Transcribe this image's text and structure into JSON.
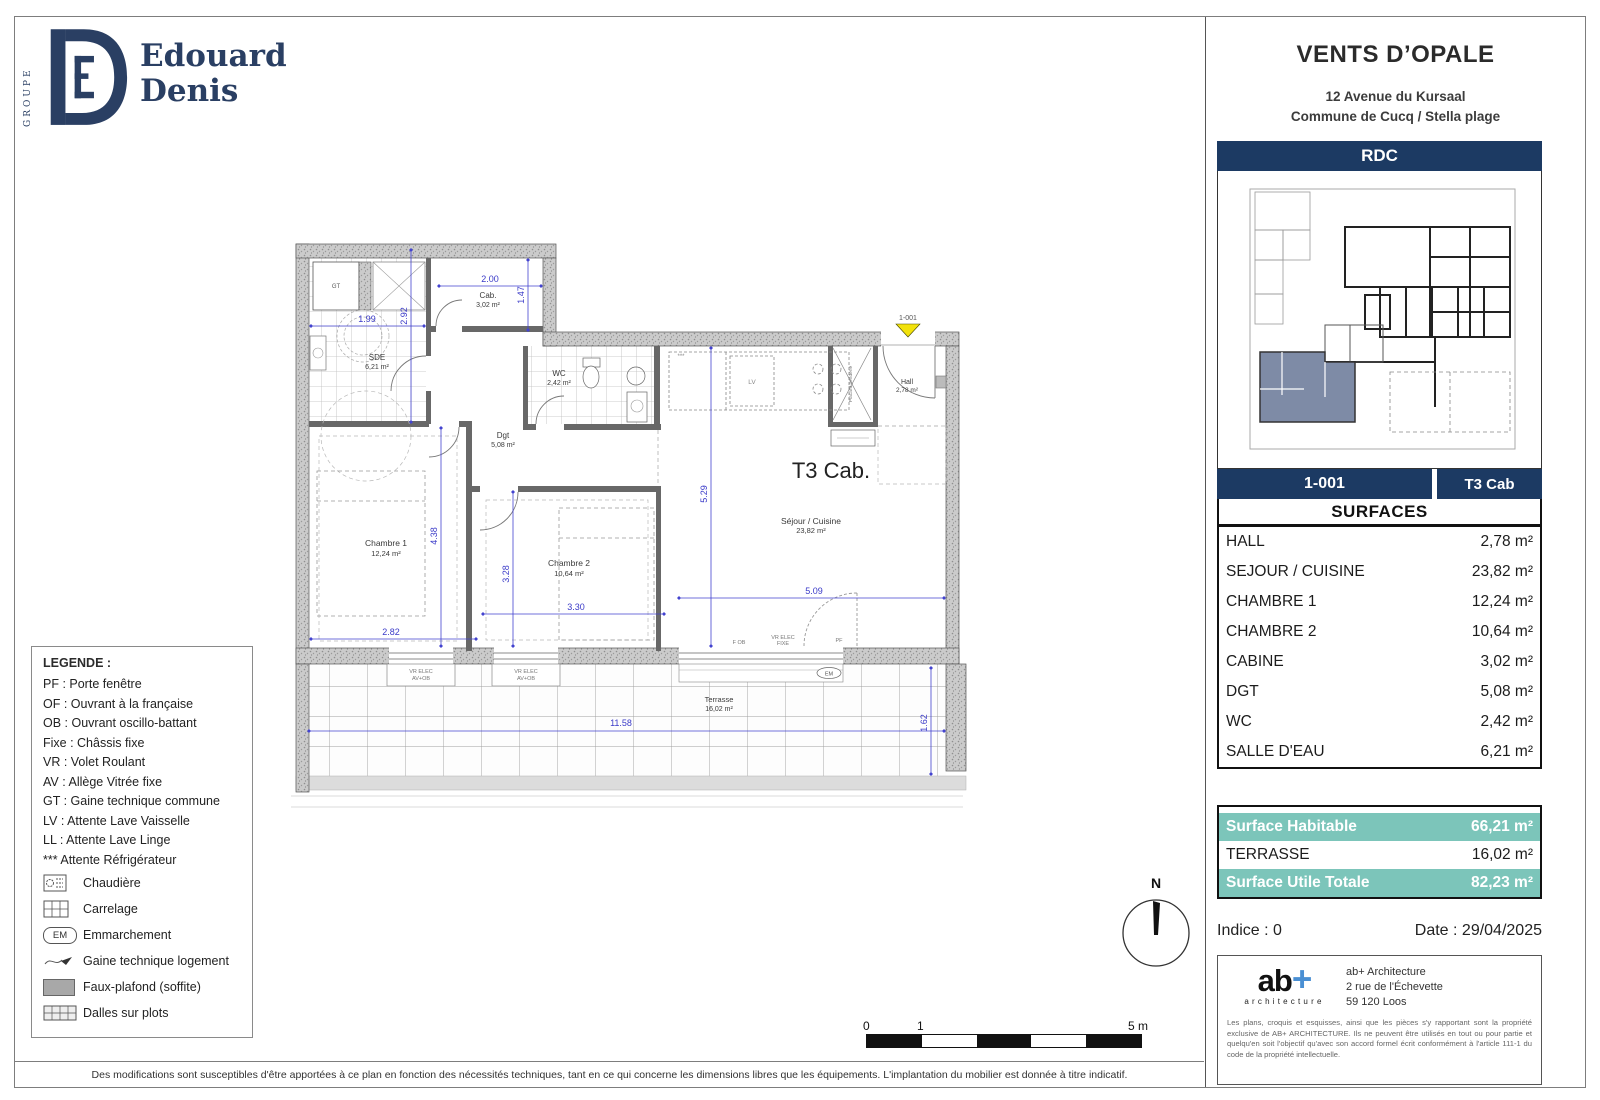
{
  "branding": {
    "groupe": "GROUPE",
    "line1": "Edouard",
    "line2": "Denis"
  },
  "project": {
    "title": "VENTS D’OPALE",
    "address1": "12 Avenue du Kursaal",
    "address2": "Commune de Cucq / Stella plage",
    "level": "RDC",
    "unit": "1-001",
    "unit_type": "T3 Cab"
  },
  "surfaces": {
    "header": "SURFACES",
    "rows": [
      {
        "label": "HALL",
        "value": "2,78 m²"
      },
      {
        "label": "SEJOUR / CUISINE",
        "value": "23,82 m²"
      },
      {
        "label": "CHAMBRE 1",
        "value": "12,24 m²"
      },
      {
        "label": "CHAMBRE 2",
        "value": "10,64 m²"
      },
      {
        "label": "CABINE",
        "value": "3,02 m²"
      },
      {
        "label": "DGT",
        "value": "5,08 m²"
      },
      {
        "label": "WC",
        "value": "2,42 m²"
      },
      {
        "label": "SALLE D'EAU",
        "value": "6,21 m²"
      }
    ]
  },
  "totals": [
    {
      "label": "Surface Habitable",
      "value": "66,21 m²"
    },
    {
      "label": "TERRASSE",
      "value": "16,02 m²"
    },
    {
      "label": "Surface Utile Totale",
      "value": "82,23 m²"
    }
  ],
  "meta": {
    "indice": "Indice : 0",
    "date": "Date : 29/04/2025"
  },
  "architect": {
    "logo": "ab",
    "logo_plus": "+",
    "logo_sub": "architecture",
    "name": "ab+ Architecture",
    "addr1": "2 rue de l'Échevette",
    "addr2": "59 120 Loos",
    "notice": "Les plans, croquis et esquisses, ainsi que les pièces s'y rapportant sont la propriété exclusive de AB+ ARCHITECTURE. Ils ne peuvent être utilisés en tout ou pour partie et quelqu'en soit l'objectif qu'avec son accord formel écrit conformément à l'article 111-1 du code de la propriété intellectuelle."
  },
  "footer": {
    "disclaimer": "Des modifications sont susceptibles d'être apportées à ce plan en fonction des nécessités techniques, tant en ce qui concerne les dimensions libres que les équipements. L'implantation du mobilier est donnée à titre indicatif."
  },
  "legend": {
    "title": "LEGENDE :",
    "items": [
      "PF : Porte fenêtre",
      "OF : Ouvrant à la française",
      "OB : Ouvrant oscillo-battant",
      "Fixe : Châssis fixe",
      "VR : Volet Roulant",
      "AV : Allège Vitrée fixe",
      "GT : Gaine technique commune",
      "LV : Attente Lave Vaisselle",
      "LL : Attente Lave Linge",
      "*** Attente Réfrigérateur"
    ],
    "icons": [
      {
        "label": "Chaudière"
      },
      {
        "label": "Carrelage"
      },
      {
        "label": "Emmarchement",
        "badge": "EM"
      },
      {
        "label": "Gaine technique logement"
      },
      {
        "label": "Faux-plafond (soffite)"
      },
      {
        "label": "Dalles sur plots"
      }
    ]
  },
  "plan": {
    "unit_label": "T3 Cab.",
    "door_tag": "1-001",
    "rooms": {
      "sde": {
        "name": "SDE",
        "area": "6,21 m²"
      },
      "cab": {
        "name": "Cab.",
        "area": "3,02 m²"
      },
      "wc": {
        "name": "WC",
        "area": "2,42 m²"
      },
      "dgt": {
        "name": "Dgt",
        "area": "5,08 m²"
      },
      "hall": {
        "name": "Hall",
        "area": "2,78 m²"
      },
      "ch1": {
        "name": "Chambre 1",
        "area": "12,24 m²"
      },
      "ch2": {
        "name": "Chambre 2",
        "area": "10,64 m²"
      },
      "sejour": {
        "name": "Séjour / Cuisine",
        "area": "23,82 m²"
      },
      "terrasse": {
        "name": "Terrasse",
        "area": "16,02 m²"
      }
    },
    "dims": {
      "cab_w": "2.00",
      "cab_h": "1.47",
      "sde_w": "1.99",
      "sde_h": "2.92",
      "sej_h": "5.29",
      "sej_w": "5.09",
      "ch1_h": "4.38",
      "ch1_w": "2.82",
      "ch2_h": "3.28",
      "ch2_w": "3.30",
      "ter_w": "11.58",
      "ter_h": "1.62"
    },
    "tags": {
      "gt": "GT",
      "lv": "LV",
      "em": "EM",
      "f_ob": "F OB",
      "vr_elec": "VR ELEC",
      "fixe": "FIXE",
      "av_ob": "AV+OB",
      "pf": "PF",
      "placard": "Placard penderie",
      "fridge": "***"
    }
  },
  "compass": {
    "n": "N"
  },
  "scalebar": {
    "t0": "0",
    "t1": "1",
    "t5": "5 m"
  },
  "colors": {
    "navy": "#1c3a63",
    "teal": "#7cc5ba",
    "dim_blue": "#4343cf",
    "marker_yellow": "#f2e20c"
  }
}
